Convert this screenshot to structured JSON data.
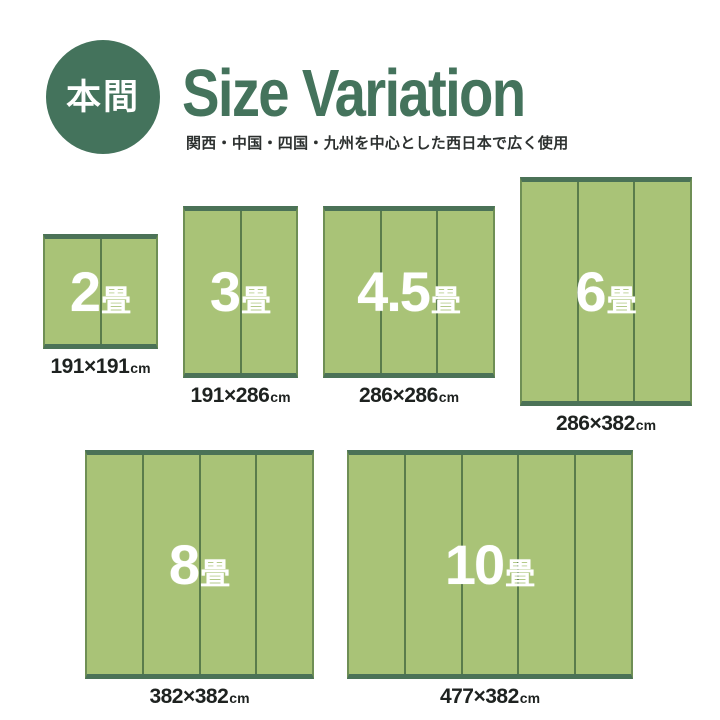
{
  "header": {
    "badge_label": "本間",
    "title": "Size Variation",
    "subtitle": "関西・中国・四国・九州を中心とした西日本で広く使用"
  },
  "colors": {
    "brand_green": "#44735c",
    "mat_fill": "#a9c377",
    "mat_edge": "#4b7257",
    "mat_edge_side": "#6f8f55",
    "mat_seam": "#5a7c4b",
    "text_dark": "#1e2220",
    "subtitle_dark": "#2d3130",
    "white": "#ffffff"
  },
  "mats": [
    {
      "name": "2jo",
      "count": "2",
      "count_unit": "畳",
      "size_label": "191×191",
      "size_unit": "cm",
      "panels": 2,
      "width_cm": 191,
      "depth_cm": 191,
      "row": 1
    },
    {
      "name": "3jo",
      "count": "3",
      "count_unit": "畳",
      "size_label": "191×286",
      "size_unit": "cm",
      "panels": 2,
      "width_cm": 191,
      "depth_cm": 286,
      "row": 1
    },
    {
      "name": "4-5jo",
      "count": "4.5",
      "count_unit": "畳",
      "size_label": "286×286",
      "size_unit": "cm",
      "panels": 3,
      "width_cm": 286,
      "depth_cm": 286,
      "row": 1
    },
    {
      "name": "6jo",
      "count": "6",
      "count_unit": "畳",
      "size_label": "286×382",
      "size_unit": "cm",
      "panels": 3,
      "width_cm": 286,
      "depth_cm": 382,
      "row": 1
    },
    {
      "name": "8jo",
      "count": "8",
      "count_unit": "畳",
      "size_label": "382×382",
      "size_unit": "cm",
      "panels": 4,
      "width_cm": 382,
      "depth_cm": 382,
      "row": 2
    },
    {
      "name": "10jo",
      "count": "10",
      "count_unit": "畳",
      "size_label": "477×382",
      "size_unit": "cm",
      "panels": 5,
      "width_cm": 477,
      "depth_cm": 382,
      "row": 2
    }
  ]
}
